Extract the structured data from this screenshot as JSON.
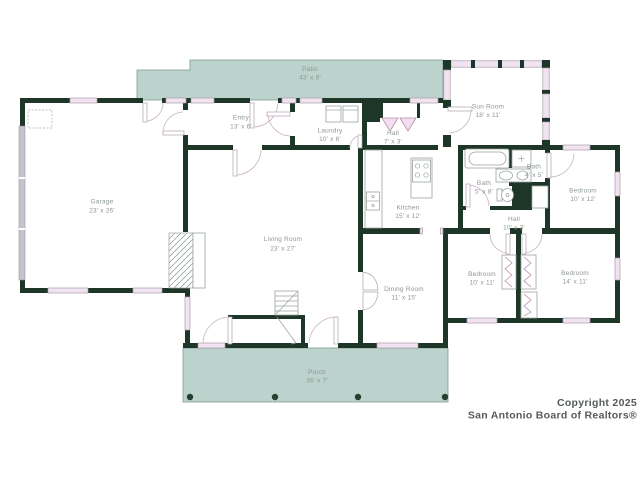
{
  "colors": {
    "wall": "#1d3627",
    "patio_porch_fill": "#bcd2cc",
    "window_fill": "#f1e4f0",
    "door_arc": "#c9b2c4",
    "room_label": "#8d9793",
    "copyright_text": "#555b58"
  },
  "floor_plan": {
    "rooms": [
      {
        "id": "patio",
        "name": "Patio",
        "dims": "43' x 9'"
      },
      {
        "id": "sun-room",
        "name": "Sun Room",
        "dims": "18' x 11'"
      },
      {
        "id": "entry",
        "name": "Entry",
        "dims": "13' x 6'"
      },
      {
        "id": "laundry",
        "name": "Laundry",
        "dims": "10' x 6'"
      },
      {
        "id": "hall-upper",
        "name": "Hall",
        "dims": "7' x 3'"
      },
      {
        "id": "garage",
        "name": "Garage",
        "dims": "23' x 26'"
      },
      {
        "id": "kitchen",
        "name": "Kitchen",
        "dims": "15' x 12'"
      },
      {
        "id": "bath-main",
        "name": "Bath",
        "dims": "5' x 8'"
      },
      {
        "id": "bath-small",
        "name": "Bath",
        "dims": "4' x 5'"
      },
      {
        "id": "hall-bedrooms",
        "name": "Hall",
        "dims": "10' x 3'"
      },
      {
        "id": "bedroom-northeast",
        "name": "Bedroom",
        "dims": "10' x 12'"
      },
      {
        "id": "living-room",
        "name": "Living Room",
        "dims": "23' x 27'"
      },
      {
        "id": "dining-room",
        "name": "Dining Room",
        "dims": "11' x 15'"
      },
      {
        "id": "bedroom-south",
        "name": "Bedroom",
        "dims": "10' x 11'"
      },
      {
        "id": "bedroom-southeast",
        "name": "Bedroom",
        "dims": "14' x 11'"
      },
      {
        "id": "porch",
        "name": "Porch",
        "dims": "36' x 7'"
      }
    ],
    "fixtures": [
      "washer",
      "dryer",
      "range",
      "kitchen-sink",
      "bathtub",
      "shower",
      "vanity-sinks",
      "toilet",
      "fireplace",
      "staircase",
      "porch-posts",
      "garage-door",
      "bifold-closet-doors",
      "french-doors"
    ]
  },
  "copyright": {
    "line1": "Copyright 2025",
    "line2": "San Antonio Board of Realtors®"
  }
}
